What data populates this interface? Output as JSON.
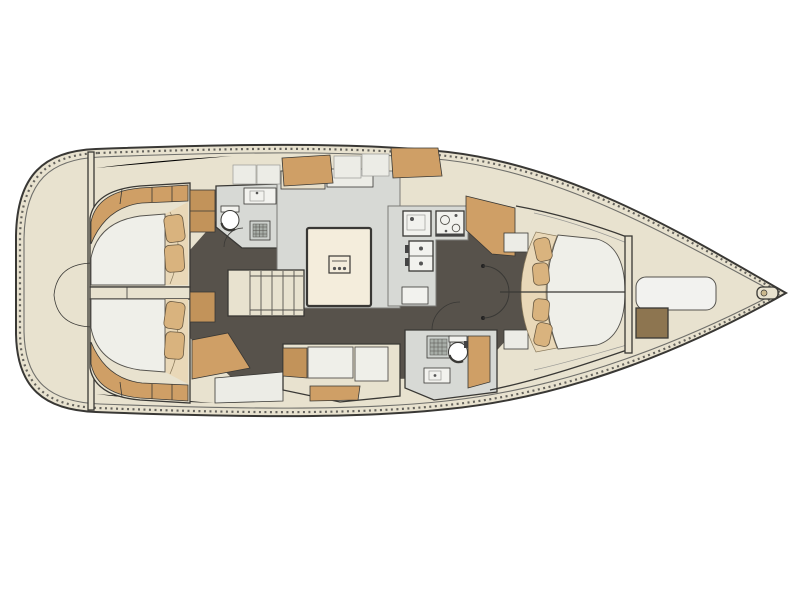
{
  "figure": {
    "description": "Top-down interior deck plan of a sailing yacht, bow pointing right: two aft double cabins, two heads with toilet, sink and shower, companionway stairs, saloon with table and U-settee, linear galley with stove and sinks, straight settee, and a forward owner cabin with island double berth, bow locker and windlass"
  },
  "colors": {
    "page_bg": "#ffffff",
    "hull_cream": "#e8e2cf",
    "outline": "#393835",
    "rail_gray": "#6f6f6b",
    "floor_charcoal": "#57524b",
    "compartment_gray": "#d7d9d5",
    "fixture_white": "#f2f2ee",
    "mattress_white": "#efefe9",
    "wood": "#cf9f66",
    "wood_dark": "#c2935a",
    "pillow_tan": "#d9b37e",
    "platform_cream": "#e9d8b8",
    "table_cream": "#f4eddc",
    "panel_white": "#ecece6",
    "grate_gray": "#a7ada7",
    "grate_light": "#cdd1cd",
    "bow_box_brown": "#8d7550",
    "back_cream": "#e7dfcb",
    "seam_gray": "#9a9a96",
    "hatch_dark": "#4c4b48"
  },
  "components": [
    "hull",
    "toe-rail",
    "transom-bulkhead",
    "lazarette-hatch",
    "aft-cabin-port",
    "aft-cabin-starboard",
    "berth-mattress",
    "berth-pillow",
    "wardrobe",
    "companionway-stairs",
    "head-port",
    "head-starboard",
    "toilet",
    "washbasin",
    "shower-grate",
    "door-swing",
    "salon-seating",
    "salon-table",
    "galley",
    "galley-sink",
    "stove",
    "refrigerator",
    "settee",
    "forward-cabin",
    "island-berth",
    "forward-bulkhead",
    "bow-locker",
    "anchor-windlass",
    "bow-roller"
  ]
}
